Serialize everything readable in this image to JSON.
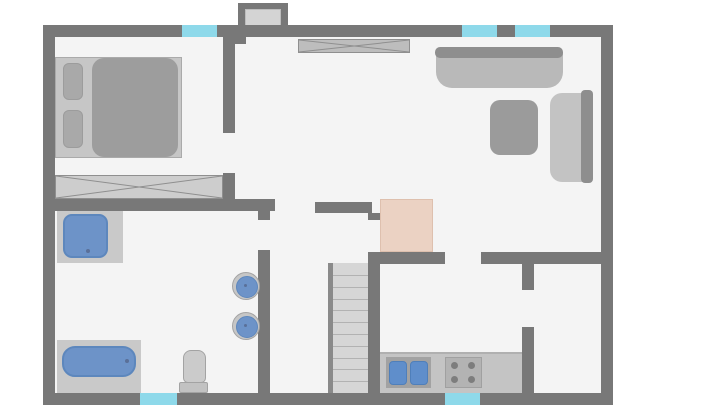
{
  "meta": {
    "type": "floor-plan",
    "description": "Top-down 2D apartment floor plan with bedroom, hallway, living room, bathroom, kitchen, staircase and storage room",
    "visible_text": []
  },
  "colors": {
    "outside": "#ffffff",
    "floor": "#f4f4f4",
    "wall": "#787878",
    "window": "#8ed9ea",
    "door-leaf": "#d4d4d4",
    "closet-fill": "#bdbdbd",
    "closet-line": "#8f8f8f",
    "wardrobe-fill": "#cdcdcd",
    "furniture-light": "#c6c6c6",
    "furniture-mid": "#a9a9a9",
    "furniture-dark": "#8e8e8e",
    "mattress": "#9d9d9d",
    "sofa-body": "#b9b9b9",
    "ottoman": "#9b9b9b",
    "couch-body": "#c3c3c3",
    "fixture-blue": "#6d93c8",
    "fixture-blue-border": "#5d87bd",
    "fixture-platform": "#c9c9c9",
    "ceramic": "#cbcbcb",
    "ceramic-border": "#a3a3a3",
    "counter": "#c4c4c4",
    "counter-module": "#a2a2a2",
    "stove": "#b3b3b3",
    "burner": "#7d7d7d",
    "stair-fill": "#d6d6d6",
    "tread-line": "#b2b2b2",
    "stair-rail": "#8a8a8a",
    "fireplace": "#ebd2c3",
    "fireplace-border": "#dec0ae",
    "drain": "#5a7099"
  },
  "stairs": {
    "steps": 10
  },
  "windows": [
    {
      "id": "bedroom-window",
      "wall": "top"
    },
    {
      "id": "living-room-window-1",
      "wall": "top"
    },
    {
      "id": "living-room-window-2",
      "wall": "top"
    },
    {
      "id": "bathroom-window",
      "wall": "bottom"
    },
    {
      "id": "kitchen-window",
      "wall": "bottom"
    }
  ],
  "rooms": {
    "bedroom": {
      "furniture": [
        "double-bed",
        "pillow",
        "pillow",
        "mattress",
        "wardrobe"
      ]
    },
    "hallway": {
      "furniture": [
        "entrance-door",
        "built-in-closet"
      ]
    },
    "living_room": {
      "furniture": [
        "sofa",
        "ottoman-table",
        "loveseat",
        "fireplace-hearth"
      ]
    },
    "bathroom": {
      "furniture": [
        "shower",
        "bathtub",
        "toilet",
        "round-sink",
        "round-sink"
      ]
    },
    "kitchen": {
      "furniture": [
        "counter",
        "double-basin-sink",
        "stove-4-burners"
      ]
    },
    "stairwell": {
      "furniture": [
        "staircase"
      ]
    },
    "storage_room": {
      "furniture": []
    }
  }
}
